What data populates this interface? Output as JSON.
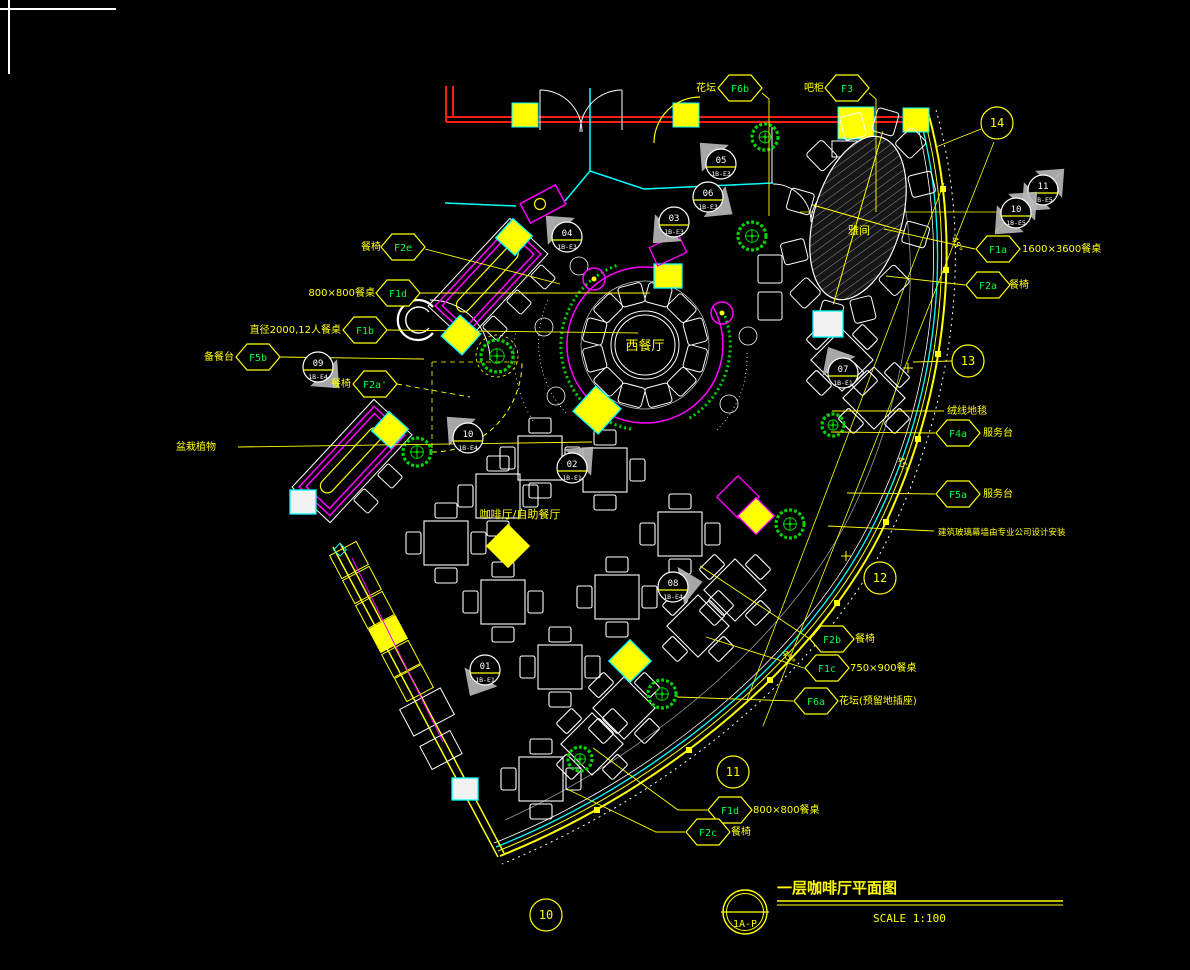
{
  "title_block": {
    "sheet": "1A-P",
    "title": "一层咖啡厅平面图",
    "scale": "SCALE  1:100"
  },
  "colors": {
    "line_yellow": "#ffff00",
    "line_cyan": "#00ffff",
    "line_magenta": "#ff00ff",
    "line_white": "#ffffff",
    "line_red": "#ff1a1a",
    "plant_green": "#00d400",
    "code_green": "#00ff45",
    "flag_gray": "#b9b9b9"
  },
  "annotations": {
    "hex_labels": [
      {
        "code": "F6b",
        "cx": 740,
        "cy": 88,
        "leader": [
          [
            762,
            93
          ],
          [
            769,
            99
          ],
          [
            769,
            216
          ]
        ]
      },
      {
        "code": "F3",
        "cx": 847,
        "cy": 88,
        "leader": [
          [
            869,
            93
          ],
          [
            876,
            99
          ],
          [
            876,
            212
          ]
        ]
      },
      {
        "code": "F2e",
        "cx": 403,
        "cy": 247,
        "leader": [
          [
            425,
            249
          ],
          [
            560,
            284
          ]
        ]
      },
      {
        "code": "F1d",
        "cx": 398,
        "cy": 293,
        "leader": [
          [
            420,
            293
          ],
          [
            650,
            293
          ]
        ]
      },
      {
        "code": "F1b",
        "cx": 365,
        "cy": 330,
        "leader": [
          [
            387,
            330
          ],
          [
            638,
            333
          ]
        ]
      },
      {
        "code": "F5b",
        "cx": 258,
        "cy": 357,
        "leader": [
          [
            280,
            357
          ],
          [
            424,
            359
          ]
        ]
      },
      {
        "code": "F2a'",
        "cx": 375,
        "cy": 384,
        "dash": true,
        "leader": [
          [
            397,
            384
          ],
          [
            470,
            397
          ]
        ]
      },
      {
        "code": "F1a",
        "cx": 998,
        "cy": 249,
        "leader": [
          [
            975,
            249
          ],
          [
            884,
            229
          ]
        ]
      },
      {
        "code": "F2a",
        "cx": 988,
        "cy": 285,
        "leader": [
          [
            965,
            285
          ],
          [
            886,
            276
          ]
        ]
      },
      {
        "code": "F4a",
        "cx": 958,
        "cy": 433,
        "leader": [
          [
            935,
            433
          ],
          [
            831,
            432
          ]
        ]
      },
      {
        "code": "F5a",
        "cx": 958,
        "cy": 494,
        "leader": [
          [
            935,
            494
          ],
          [
            847,
            493
          ]
        ]
      },
      {
        "code": "F2b",
        "cx": 832,
        "cy": 639,
        "leader": [
          [
            810,
            639
          ],
          [
            700,
            566
          ]
        ]
      },
      {
        "code": "F1c",
        "cx": 827,
        "cy": 668,
        "leader": [
          [
            804,
            668
          ],
          [
            706,
            637
          ]
        ]
      },
      {
        "code": "F6a",
        "cx": 816,
        "cy": 701,
        "leader": [
          [
            793,
            701
          ],
          [
            677,
            697
          ]
        ]
      },
      {
        "code": "F1d",
        "cx": 730,
        "cy": 810,
        "leader": [
          [
            707,
            810
          ],
          [
            678,
            810
          ],
          [
            593,
            748
          ]
        ]
      },
      {
        "code": "F2c",
        "cx": 708,
        "cy": 832,
        "leader": [
          [
            685,
            832
          ],
          [
            656,
            832
          ],
          [
            567,
            789
          ]
        ]
      }
    ],
    "markers": [
      {
        "num": "05",
        "code": "1B-E3",
        "cx": 721,
        "cy": 164,
        "flag": 45
      },
      {
        "num": "06",
        "code": "1B-E3",
        "cx": 708,
        "cy": 197,
        "flag": 215
      },
      {
        "num": "03",
        "code": "1B-E3",
        "cx": 674,
        "cy": 222,
        "flag": 315
      },
      {
        "num": "04",
        "code": "1B-E3",
        "cx": 567,
        "cy": 237,
        "flag": 45
      },
      {
        "num": "09",
        "code": "1B-E4",
        "cx": 318,
        "cy": 367,
        "flag": 225
      },
      {
        "num": "10",
        "code": "1B-E4",
        "cx": 468,
        "cy": 438,
        "flag": 45
      },
      {
        "num": "02",
        "code": "1B-E1",
        "cx": 572,
        "cy": 468,
        "flag": 135
      },
      {
        "num": "07",
        "code": "1B-E1",
        "cx": 843,
        "cy": 373,
        "flag": 60
      },
      {
        "num": "08",
        "code": "1B-E4",
        "cx": 673,
        "cy": 587,
        "flag": 170
      },
      {
        "num": "01",
        "code": "1B-E1",
        "cx": 485,
        "cy": 670,
        "flag": 300
      }
    ],
    "diamond_markers": [
      {
        "num": "11",
        "code": "1B-E5",
        "cx": 1043,
        "cy": 190
      },
      {
        "num": "10",
        "code": "1B-E5",
        "cx": 1016,
        "cy": 213
      }
    ],
    "bubbles": [
      {
        "num": "14",
        "cx": 997,
        "cy": 123,
        "leader": [
          [
            981,
            129
          ],
          [
            936,
            147
          ]
        ]
      },
      {
        "num": "13",
        "cx": 968,
        "cy": 361,
        "leader": [
          [
            952,
            361
          ],
          [
            913,
            362
          ]
        ]
      },
      {
        "num": "12",
        "cx": 880,
        "cy": 578
      },
      {
        "num": "11",
        "cx": 733,
        "cy": 772
      },
      {
        "num": "10",
        "cx": 546,
        "cy": 915
      }
    ],
    "leader_lines": [
      {
        "pts": [
          [
            238,
            447
          ],
          [
            592,
            442
          ]
        ]
      },
      {
        "pts": [
          [
            828,
            526
          ],
          [
            934,
            531
          ]
        ]
      },
      {
        "pts": [
          [
            832,
            411
          ],
          [
            944,
            411
          ]
        ]
      }
    ],
    "texts": [
      {
        "t": "花坛",
        "x": 716,
        "y": 91,
        "a": "end"
      },
      {
        "t": "吧柜",
        "x": 824,
        "y": 91,
        "a": "end"
      },
      {
        "t": "餐椅",
        "x": 381,
        "y": 250,
        "a": "end"
      },
      {
        "t": "800×800餐桌",
        "x": 375,
        "y": 296,
        "a": "end"
      },
      {
        "t": "直径2000,12人餐桌",
        "x": 341,
        "y": 333,
        "a": "end"
      },
      {
        "t": "备餐台",
        "x": 234,
        "y": 360,
        "a": "end"
      },
      {
        "t": "餐椅",
        "x": 351,
        "y": 387,
        "a": "end"
      },
      {
        "t": "盆栽植物",
        "x": 196,
        "y": 450,
        "a": "middle"
      },
      {
        "t": "西餐厅",
        "x": 645,
        "y": 350,
        "a": "middle",
        "s": 13
      },
      {
        "t": "咖啡厅/自助餐厅",
        "x": 520,
        "y": 518,
        "a": "middle",
        "s": 11
      },
      {
        "t": "雅间",
        "x": 859,
        "y": 234,
        "a": "middle",
        "s": 11
      },
      {
        "t": "1600×3600餐桌",
        "x": 1022,
        "y": 252,
        "a": "start"
      },
      {
        "t": "餐椅",
        "x": 1009,
        "y": 288,
        "a": "start"
      },
      {
        "t": "绒线地毯",
        "x": 947,
        "y": 414,
        "a": "start"
      },
      {
        "t": "服务台",
        "x": 983,
        "y": 436,
        "a": "start"
      },
      {
        "t": "服务台",
        "x": 983,
        "y": 497,
        "a": "start"
      },
      {
        "t": "建筑玻璃幕墙由专业公司设计安装",
        "x": 938,
        "y": 535,
        "a": "start",
        "s": 8.5
      },
      {
        "t": "餐椅",
        "x": 855,
        "y": 642,
        "a": "start"
      },
      {
        "t": "750×900餐桌",
        "x": 850,
        "y": 671,
        "a": "start"
      },
      {
        "t": "花坛(预留地插座)",
        "x": 839,
        "y": 704,
        "a": "start"
      },
      {
        "t": "800×800餐桌",
        "x": 753,
        "y": 813,
        "a": "start"
      },
      {
        "t": "餐椅",
        "x": 731,
        "y": 835,
        "a": "start"
      },
      {
        "t": "45°",
        "x": 951,
        "y": 238,
        "rot": 68,
        "s": 9
      },
      {
        "t": "45°",
        "x": 897,
        "y": 458,
        "rot": 68,
        "s": 9
      },
      {
        "t": "45°",
        "x": 781,
        "y": 653,
        "rot": 50,
        "s": 9
      }
    ]
  }
}
